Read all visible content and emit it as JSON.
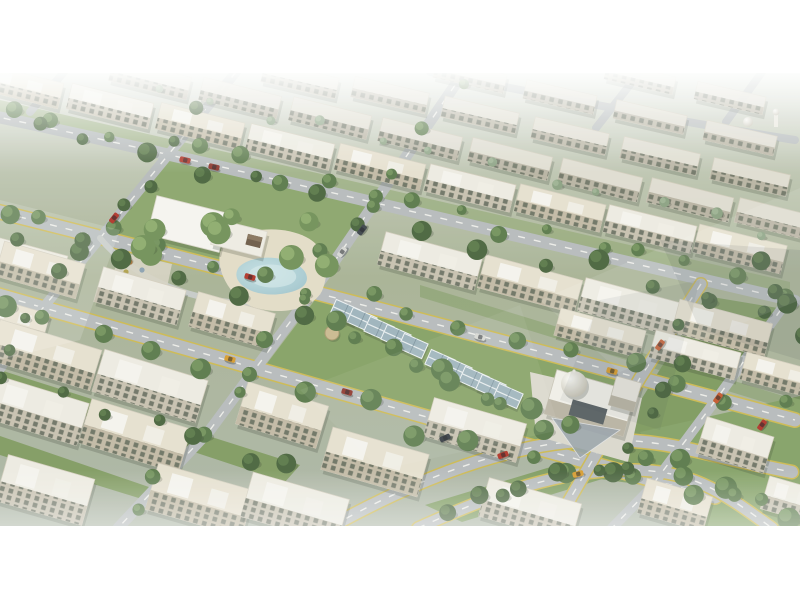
{
  "scene": {
    "description": "Aerial 3D architectural render of a residential compound: rows of beige low-rise apartment blocks, tree-lined diagonal boulevards with yellow-edged dual carriageways, central park with white shade canopy and teal pond, greenhouse-style glass pavilions on a green median, domed clubhouse-mosque, scattered cars, hazy white sky band at top and white letterbox bars",
    "canvas": {
      "width": 800,
      "height": 600
    },
    "photo_band": {
      "top": 73,
      "bottom": 526
    },
    "palette": {
      "letterbox": "#ffffff",
      "road": "#b6babc",
      "road_minor": "#c6cac8",
      "road_line": "#f4f3ee",
      "road_edge_yellow": "#cdb84e",
      "grass": "#8aa46a",
      "grass_dark": "#7c985c",
      "plaza": "#e4dcc6",
      "pond": "#a7cbd2",
      "canopy_white": "#f7f5f0",
      "pavilion_glass": "#9db2bc",
      "shadow": "rgba(40,50,35,0.22)"
    },
    "grass_patches": [
      {
        "pts": "163,155 379,204 312,293 98,237",
        "fill": "#8aa46a",
        "o": 1
      },
      {
        "pts": "318,296 634,377 585,455 262,370",
        "fill": "#84a062",
        "o": 1
      },
      {
        "pts": "706,296 778,308 652,486 592,478",
        "fill": "#7c985c",
        "o": 1
      },
      {
        "pts": "425,505 600,452 638,468 462,522",
        "fill": "#7d9a5e",
        "o": 1
      },
      {
        "pts": "640,432 800,396 800,527 690,527",
        "fill": "#83a065",
        "o": 1
      },
      {
        "pts": "0,370 300,465 285,482 0,388",
        "fill": "#7c985c",
        "o": 0.95
      },
      {
        "pts": "0,436 245,520 232,527 0,455",
        "fill": "#7c985c",
        "o": 0.95
      },
      {
        "pts": "0,100 790,282 790,296 0,114",
        "fill": "#8aa46a",
        "o": 0.55
      },
      {
        "pts": "420,285 790,398 790,410 420,297",
        "fill": "#7c985c",
        "o": 0.5
      }
    ],
    "roads": [
      {
        "d": "M 430,72 C 560,98 680,122 795,140",
        "w": 8,
        "dash": false,
        "yellow": false,
        "minor": false
      },
      {
        "d": "M -12,115 C 140,146 360,200 795,301",
        "w": 12,
        "dash": true,
        "yellow": false,
        "minor": false
      },
      {
        "d": "M -12,209 C 200,262 500,340 795,420",
        "w": 13,
        "dash": true,
        "yellow": true,
        "minor": false
      },
      {
        "d": "M -12,292 C 200,352 460,428 715,497",
        "w": 13,
        "dash": true,
        "yellow": true,
        "minor": false
      },
      {
        "d": "M 332,526 C 430,472 520,441 600,440 C 672,439 706,456 792,472",
        "w": 12,
        "dash": true,
        "yellow": true,
        "minor": false
      },
      {
        "d": "M 418,528 C 500,491 560,471 625,470 C 692,469 722,492 772,528",
        "w": 11,
        "dash": true,
        "yellow": true,
        "minor": false
      },
      {
        "d": "M 236,72 L 20,336 L -14,392",
        "w": 10,
        "dash": true,
        "yellow": false,
        "minor": false
      },
      {
        "d": "M 464,72 L 330,268 L 210,430 L 118,528",
        "w": 11,
        "dash": true,
        "yellow": false,
        "minor": false
      },
      {
        "d": "M 701,284 L 640,378 L 566,506 L 556,528",
        "w": 11,
        "dash": true,
        "yellow": true,
        "minor": false
      },
      {
        "d": "M 790,297 L 718,397 L 648,491 L 612,528",
        "w": 10,
        "dash": true,
        "yellow": false,
        "minor": false
      },
      {
        "d": "M 640,72 L 596,128",
        "w": 8,
        "dash": false,
        "yellow": false,
        "minor": false
      },
      {
        "d": "M 762,72 L 726,122",
        "w": 8,
        "dash": false,
        "yellow": false,
        "minor": false
      },
      {
        "d": "M 64,72 L 30,112",
        "w": 8,
        "dash": false,
        "yellow": false,
        "minor": false
      },
      {
        "d": "M 100,238 C 150,300 260,318 315,292",
        "w": 6,
        "dash": false,
        "yellow": false,
        "minor": true
      }
    ],
    "park": {
      "plaza_path": "M 222,247 C 240,228 280,224 306,237 C 326,247 331,269 322,291 C 312,310 281,315 256,308 C 232,301 212,268 222,247 Z",
      "play_area": "120,252 172,264 166,292 112,278",
      "pond_path": "M 239,267 C 252,254 282,256 296,264 C 309,271 311,283 299,289 C 282,297 258,296 246,288 C 236,282 234,274 239,267 Z",
      "pond_inner": "M 252,269 C 262,262 284,264 292,270 C 299,275 297,282 288,285 C 274,290 258,287 251,281 C 247,277 248,272 252,269 Z",
      "canopy_main": {
        "x": 188,
        "y": 224,
        "w": 74,
        "h": 40,
        "rot": 14
      },
      "canopy_ext": {
        "x": 239,
        "y": 238,
        "w": 52,
        "h": 26,
        "rot": 14
      },
      "gazebo": {
        "x": 254,
        "y": 241,
        "w": 15,
        "h": 11,
        "rot": 14
      },
      "playground": [
        [
          130,
          262,
          "#c9803a"
        ],
        [
          142,
          270,
          "#8aa0b0"
        ],
        [
          155,
          260,
          "#b05548"
        ],
        [
          126,
          272,
          "#b0a04a"
        ]
      ]
    },
    "pavilions": {
      "unit_w": 26,
      "unit_h": 16,
      "rot": 24,
      "units": [
        [
          345,
          312
        ],
        [
          362,
          320
        ],
        [
          379,
          329
        ],
        [
          396,
          337
        ],
        [
          413,
          346
        ],
        [
          440,
          362
        ],
        [
          457,
          370
        ],
        [
          474,
          379
        ],
        [
          491,
          387
        ],
        [
          508,
          396
        ]
      ],
      "umbrella": {
        "x": 332,
        "y": 333,
        "r": 7
      }
    },
    "mosque": {
      "platform": "530,372 642,398 628,462 536,436",
      "main": {
        "x": 590,
        "y": 403,
        "w": 82,
        "h": 46,
        "rot": 16
      },
      "annex": {
        "x": 625,
        "y": 394,
        "w": 26,
        "h": 30,
        "rot": 16
      },
      "dome": {
        "cx": 574,
        "cy": 384,
        "r": 13
      },
      "court": {
        "x": 588,
        "y": 412,
        "w": 36,
        "h": 16,
        "rot": 16
      },
      "canopy_tri": "552,418 620,430 580,458",
      "minaret": {
        "x": 776,
        "y": 112
      },
      "small_dome": {
        "cx": 748,
        "cy": 122,
        "r": 5
      }
    },
    "buildings": [
      [
        640,
        78,
        70,
        18,
        13,
        "far"
      ],
      [
        730,
        98,
        70,
        18,
        13,
        "far"
      ],
      [
        470,
        76,
        72,
        19,
        13,
        "far"
      ],
      [
        560,
        97,
        72,
        19,
        13,
        "far"
      ],
      [
        650,
        117,
        72,
        19,
        13,
        "far"
      ],
      [
        740,
        138,
        72,
        20,
        13,
        "far"
      ],
      [
        300,
        80,
        76,
        21,
        13,
        "far"
      ],
      [
        390,
        95,
        76,
        21,
        13,
        "far"
      ],
      [
        480,
        115,
        76,
        21,
        13,
        "far"
      ],
      [
        570,
        136,
        76,
        22,
        13,
        "far"
      ],
      [
        660,
        156,
        78,
        22,
        13,
        "far"
      ],
      [
        750,
        177,
        78,
        22,
        13,
        "far"
      ],
      [
        150,
        79,
        80,
        23,
        14,
        "far"
      ],
      [
        240,
        98,
        80,
        23,
        14,
        "far"
      ],
      [
        330,
        118,
        80,
        24,
        14,
        "far"
      ],
      [
        420,
        139,
        82,
        24,
        14,
        "far"
      ],
      [
        510,
        159,
        82,
        24,
        14,
        "far"
      ],
      [
        600,
        180,
        82,
        25,
        14,
        "far"
      ],
      [
        690,
        200,
        84,
        25,
        14,
        "far"
      ],
      [
        778,
        220,
        84,
        25,
        14,
        "far"
      ],
      [
        20,
        86,
        84,
        26,
        14,
        "warm"
      ],
      [
        110,
        106,
        84,
        26,
        14,
        "light"
      ],
      [
        200,
        126,
        86,
        27,
        14,
        "warm"
      ],
      [
        290,
        147,
        86,
        27,
        14,
        "light"
      ],
      [
        380,
        167,
        88,
        27,
        14,
        "warm"
      ],
      [
        470,
        188,
        88,
        28,
        14,
        "light"
      ],
      [
        560,
        208,
        88,
        28,
        14,
        "warm"
      ],
      [
        650,
        229,
        90,
        28,
        14,
        "light"
      ],
      [
        740,
        249,
        90,
        29,
        14,
        "warm"
      ],
      [
        430,
        261,
        100,
        34,
        15,
        "light"
      ],
      [
        530,
        284,
        100,
        34,
        15,
        "warm"
      ],
      [
        630,
        307,
        100,
        34,
        15,
        "light"
      ],
      [
        722,
        328,
        96,
        34,
        15,
        "warm"
      ],
      [
        600,
        333,
        88,
        28,
        15,
        "warm"
      ],
      [
        695,
        355,
        88,
        28,
        15,
        "light"
      ],
      [
        782,
        376,
        80,
        28,
        15,
        "warm"
      ],
      [
        28,
        262,
        74,
        32,
        15,
        "light"
      ],
      [
        12,
        320,
        70,
        32,
        16,
        "warm"
      ],
      [
        40,
        270,
        84,
        36,
        16,
        "warm"
      ],
      [
        140,
        296,
        86,
        36,
        16,
        "light"
      ],
      [
        232,
        320,
        80,
        36,
        16,
        "warm"
      ],
      [
        735,
        445,
        70,
        38,
        17,
        "light"
      ],
      [
        45,
        355,
        106,
        42,
        17,
        "warm"
      ],
      [
        150,
        386,
        108,
        44,
        17,
        "light"
      ],
      [
        282,
        415,
        84,
        44,
        17,
        "warm"
      ],
      [
        35,
        410,
        100,
        44,
        17,
        "light"
      ],
      [
        135,
        436,
        104,
        46,
        17,
        "warm"
      ],
      [
        45,
        490,
        90,
        48,
        16,
        "light"
      ],
      [
        200,
        500,
        100,
        48,
        16,
        "warm"
      ],
      [
        295,
        508,
        100,
        46,
        16,
        "light"
      ],
      [
        375,
        462,
        100,
        44,
        16,
        "warm"
      ],
      [
        475,
        430,
        96,
        40,
        16,
        "light"
      ],
      [
        530,
        510,
        96,
        40,
        16,
        "light"
      ],
      [
        675,
        505,
        68,
        36,
        16,
        "warm"
      ],
      [
        792,
        500,
        56,
        34,
        16,
        "light"
      ]
    ],
    "tree_belts": [
      {
        "x1": 10,
        "y1": 112,
        "x2": 780,
        "y2": 290,
        "n": 18,
        "r": 7,
        "jx": 14,
        "jy": 10,
        "tone": "mid"
      },
      {
        "x1": 40,
        "y1": 135,
        "x2": 760,
        "y2": 308,
        "n": 14,
        "r": 8,
        "jx": 16,
        "jy": 12,
        "tone": "dark"
      },
      {
        "x1": 0,
        "y1": 205,
        "x2": 780,
        "y2": 410,
        "n": 16,
        "r": 8,
        "jx": 14,
        "jy": 10,
        "tone": "mid"
      },
      {
        "x1": 20,
        "y1": 232,
        "x2": 300,
        "y2": 312,
        "n": 6,
        "r": 8,
        "jx": 12,
        "jy": 10,
        "tone": "dark"
      },
      {
        "x1": 0,
        "y1": 305,
        "x2": 680,
        "y2": 500,
        "n": 14,
        "r": 9,
        "jx": 14,
        "jy": 12,
        "tone": "mid"
      },
      {
        "x1": 230,
        "y1": 80,
        "x2": 0,
        "y2": 345,
        "n": 9,
        "r": 7,
        "jx": 12,
        "jy": 8,
        "tone": "dark"
      },
      {
        "x1": 462,
        "y1": 80,
        "x2": 128,
        "y2": 515,
        "n": 11,
        "r": 7,
        "jx": 12,
        "jy": 8,
        "tone": "mid"
      },
      {
        "x1": 700,
        "y1": 300,
        "x2": 620,
        "y2": 470,
        "n": 7,
        "r": 8,
        "jx": 10,
        "jy": 8,
        "tone": "dark"
      },
      {
        "x1": 330,
        "y1": 330,
        "x2": 570,
        "y2": 430,
        "n": 11,
        "r": 9,
        "jx": 20,
        "jy": 14,
        "tone": "mid"
      },
      {
        "x1": 130,
        "y1": 230,
        "x2": 320,
        "y2": 240,
        "n": 9,
        "r": 10,
        "jx": 24,
        "jy": 26,
        "tone": "light"
      },
      {
        "x1": 440,
        "y1": 505,
        "x2": 620,
        "y2": 465,
        "n": 7,
        "r": 8,
        "jx": 12,
        "jy": 8,
        "tone": "dark"
      },
      {
        "x1": 650,
        "y1": 450,
        "x2": 790,
        "y2": 515,
        "n": 7,
        "r": 9,
        "jx": 16,
        "jy": 10,
        "tone": "mid"
      },
      {
        "x1": 160,
        "y1": 90,
        "x2": 770,
        "y2": 230,
        "n": 12,
        "r": 5,
        "jx": 10,
        "jy": 8,
        "tone": "far"
      },
      {
        "x1": 10,
        "y1": 380,
        "x2": 290,
        "y2": 470,
        "n": 7,
        "r": 8,
        "jx": 10,
        "jy": 8,
        "tone": "dark"
      },
      {
        "x1": 760,
        "y1": 260,
        "x2": 798,
        "y2": 335,
        "n": 4,
        "r": 8,
        "jx": 8,
        "jy": 8,
        "tone": "dark"
      }
    ],
    "cars": [
      {
        "x": 114,
        "y": 218,
        "rot": -52,
        "c": "#b03226"
      },
      {
        "x": 185,
        "y": 160,
        "rot": 13,
        "c": "#b03226"
      },
      {
        "x": 214,
        "y": 167,
        "rot": 13,
        "c": "#8c2f26"
      },
      {
        "x": 342,
        "y": 252,
        "rot": -53,
        "c": "#d8d8d4"
      },
      {
        "x": 362,
        "y": 230,
        "rot": -53,
        "c": "#3a4148"
      },
      {
        "x": 250,
        "y": 277,
        "rot": 16,
        "c": "#b03226"
      },
      {
        "x": 480,
        "y": 337,
        "rot": 16,
        "c": "#d8d8d4"
      },
      {
        "x": 612,
        "y": 371,
        "rot": 16,
        "c": "#d89a2b"
      },
      {
        "x": 230,
        "y": 359,
        "rot": 16,
        "c": "#d89a2b"
      },
      {
        "x": 347,
        "y": 392,
        "rot": 16,
        "c": "#8c2f26"
      },
      {
        "x": 445,
        "y": 438,
        "rot": -24,
        "c": "#2e343b"
      },
      {
        "x": 503,
        "y": 455,
        "rot": -20,
        "c": "#b03226"
      },
      {
        "x": 578,
        "y": 474,
        "rot": -15,
        "c": "#d89a2b"
      },
      {
        "x": 660,
        "y": 345,
        "rot": -55,
        "c": "#c4562a"
      },
      {
        "x": 718,
        "y": 398,
        "rot": -55,
        "c": "#c4562a"
      },
      {
        "x": 762,
        "y": 425,
        "rot": -55,
        "c": "#b03226"
      }
    ],
    "haze_polys": [
      {
        "pts": "540,300 800,188 800,300 620,372",
        "fill": "#ffffff",
        "o": 0.1
      },
      {
        "pts": "300,390 520,305 560,430 380,470",
        "fill": "#ffffff",
        "o": 0.06
      },
      {
        "pts": "660,240 800,250 800,360 700,330",
        "fill": "#2e3a44",
        "o": 0.1
      },
      {
        "pts": "600,300 700,280 660,430 560,400",
        "fill": "#2e3a44",
        "o": 0.07
      },
      {
        "pts": "0,200 120,230 80,340 0,360",
        "fill": "#ffffff",
        "o": 0.16
      }
    ]
  }
}
